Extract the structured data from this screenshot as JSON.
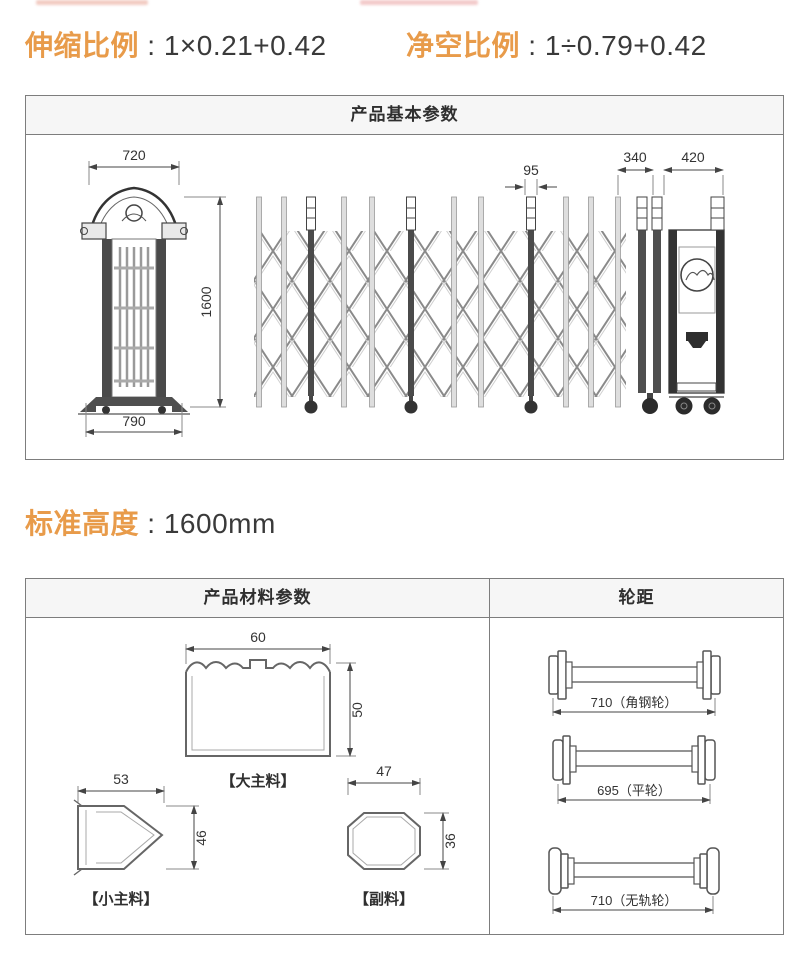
{
  "page": {
    "accent_orange": "#E89B4A",
    "text_dark": "#3a3a3a",
    "border_gray": "#7d7d7d"
  },
  "top_specs": {
    "extension": {
      "label": "伸缩比例",
      "sep": " : ",
      "value": "1×0.21+0.42"
    },
    "clearance": {
      "label": "净空比例",
      "sep": " : ",
      "value": "1÷0.79+0.42"
    }
  },
  "standard_height": {
    "label": "标准高度",
    "sep": " : ",
    "value": "1600mm"
  },
  "basic_panel": {
    "title": "产品基本参数",
    "dims": {
      "front_top": "720",
      "height": "1600",
      "front_bottom": "790",
      "pole": "95",
      "tail": "340",
      "head": "420"
    }
  },
  "material_panel": {
    "title": "产品材料参数",
    "profiles": {
      "large": {
        "label": "【大主料】",
        "w": "60",
        "h": "50"
      },
      "small": {
        "label": "【小主料】",
        "w": "53",
        "h": "46"
      },
      "aux": {
        "label": "【副料】",
        "w": "47",
        "h": "36"
      }
    }
  },
  "wheel_panel": {
    "title": "轮距",
    "tracks": {
      "angle_steel": "710（角钢轮）",
      "flat": "695（平轮）",
      "trackless": "710（无轨轮）"
    }
  }
}
